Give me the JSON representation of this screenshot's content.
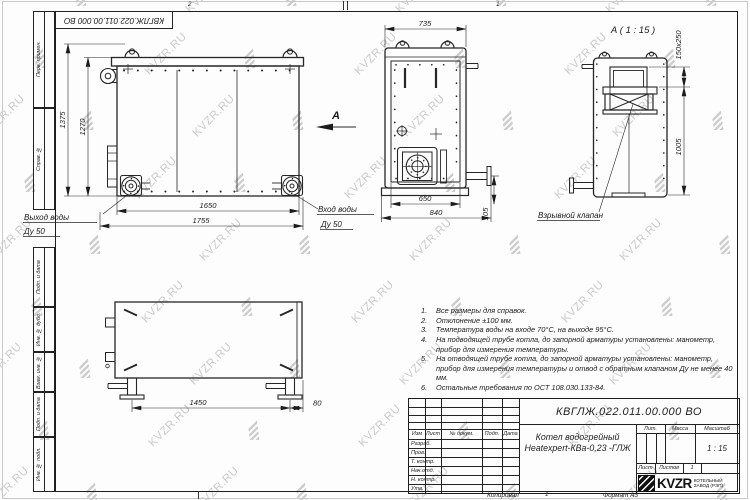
{
  "sheet": {
    "watermark_text": "KVZR.RU",
    "corner_ref": "КВГЛЖ.022.011.00.000 ВО",
    "zone_top_left": "2",
    "zone_top_right": "1",
    "zone_bottom": "1"
  },
  "left_stamp": {
    "fields": [
      "Перв. примен.",
      "Справ. №",
      "Подп. и дата",
      "Инв. № дубл.",
      "Взам. инв. №",
      "Подп. и дата",
      "Инв. № подл."
    ]
  },
  "views": {
    "front": {
      "dim_height_outer": "1375",
      "dim_height_inner": "1270",
      "dim_width_inner": "1650",
      "dim_width_outer": "1755",
      "outlet_label_1": "Выход воды",
      "outlet_label_2": "Ду 50",
      "inlet_label_1": "Вход воды",
      "inlet_label_2": "Ду 50",
      "section_label": "А"
    },
    "side": {
      "dim_top": "735",
      "dim_bottom_inner": "650",
      "dim_bottom_outer": "840",
      "dim_pipe": "105"
    },
    "detail": {
      "title": "А ( 1 : 15 )",
      "dim_opening": "150x250",
      "dim_height": "1005",
      "valve_label": "Взрывной клапан"
    },
    "plan": {
      "dim_span": "1450",
      "dim_offset": "80"
    }
  },
  "notes": {
    "items": [
      {
        "num": "1.",
        "text": "Все размеры для справок."
      },
      {
        "num": "2.",
        "text": "Отклонение ±100 мм."
      },
      {
        "num": "3.",
        "text": "Температура воды на входе 70°С, на выходе 95°С."
      },
      {
        "num": "4.",
        "text": "На подводящей трубе котла, до запорной арматуры установлены: манометр, прибор для измерения температуры."
      },
      {
        "num": "5.",
        "text": "На отводящей трубе котла, до запорной арматуры установлены: манометр, прибор для измерения температуры и отвод с обратным клапаном Ду не менее 40 мм."
      },
      {
        "num": "6.",
        "text": "Остальные требования по ОСТ 108.030.133-84."
      }
    ]
  },
  "title_block": {
    "doc_number": "КВГЛЖ.022.011.00.000 ВО",
    "product_name_line1": "Котел водогрейный",
    "product_name_line2": "Heatexpert-КВа-0,23 -ГЛЖ",
    "col_izm": "Изм",
    "col_list": "Лист",
    "col_doc": "№ докум.",
    "col_sign": "Подп.",
    "col_date": "Дата",
    "rows": [
      "Разраб.",
      "Пров.",
      "Т. контр.",
      "Нач.отд.",
      "Н. контр.",
      "Утв."
    ],
    "lit": "Лит.",
    "mass": "Масса",
    "scale": "Масштаб",
    "scale_value": "1 : 15",
    "sheet": "Лист",
    "sheets": "Листов",
    "sheets_value": "1",
    "logo_text": "KVZR",
    "logo_line1": "КОТЕЛЬНЫЙ",
    "logo_line2": "ЗАВОД (РЭП)",
    "copied": "Копировал",
    "format": "Формат А3"
  }
}
